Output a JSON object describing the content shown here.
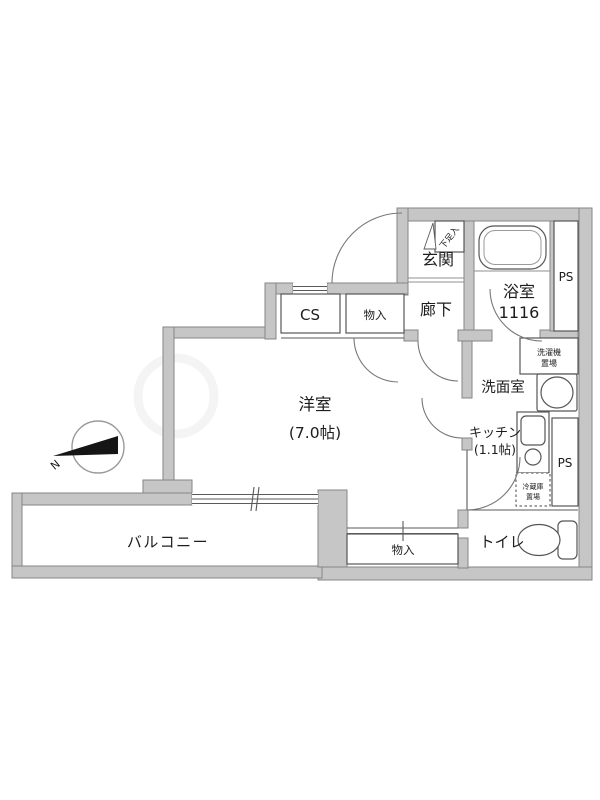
{
  "floorplan": {
    "compass": {
      "north_label": "N"
    },
    "rooms": {
      "genkan": {
        "label": "玄関"
      },
      "shoe_cabinet": {
        "label": "下足入"
      },
      "hallway": {
        "label": "廊下"
      },
      "bathroom": {
        "label": "浴室",
        "size": "1116"
      },
      "ps_upper": {
        "label": "PS"
      },
      "ps_lower": {
        "label": "PS"
      },
      "washroom": {
        "label": "洗面室"
      },
      "washer_space": {
        "line1": "洗濯機",
        "line2": "置場"
      },
      "kitchen": {
        "label": "キッチン",
        "area": "(1.1帖)"
      },
      "fridge_space": {
        "line1": "冷蔵庫",
        "line2": "置場"
      },
      "cs_closet": {
        "label": "CS"
      },
      "storage_upper": {
        "label": "物入"
      },
      "western_room": {
        "label": "洋室",
        "area": "(7.0帖)"
      },
      "storage_lower": {
        "label": "物入"
      },
      "toilet": {
        "label": "トイレ"
      },
      "balcony": {
        "label": "バルコニー"
      }
    }
  }
}
